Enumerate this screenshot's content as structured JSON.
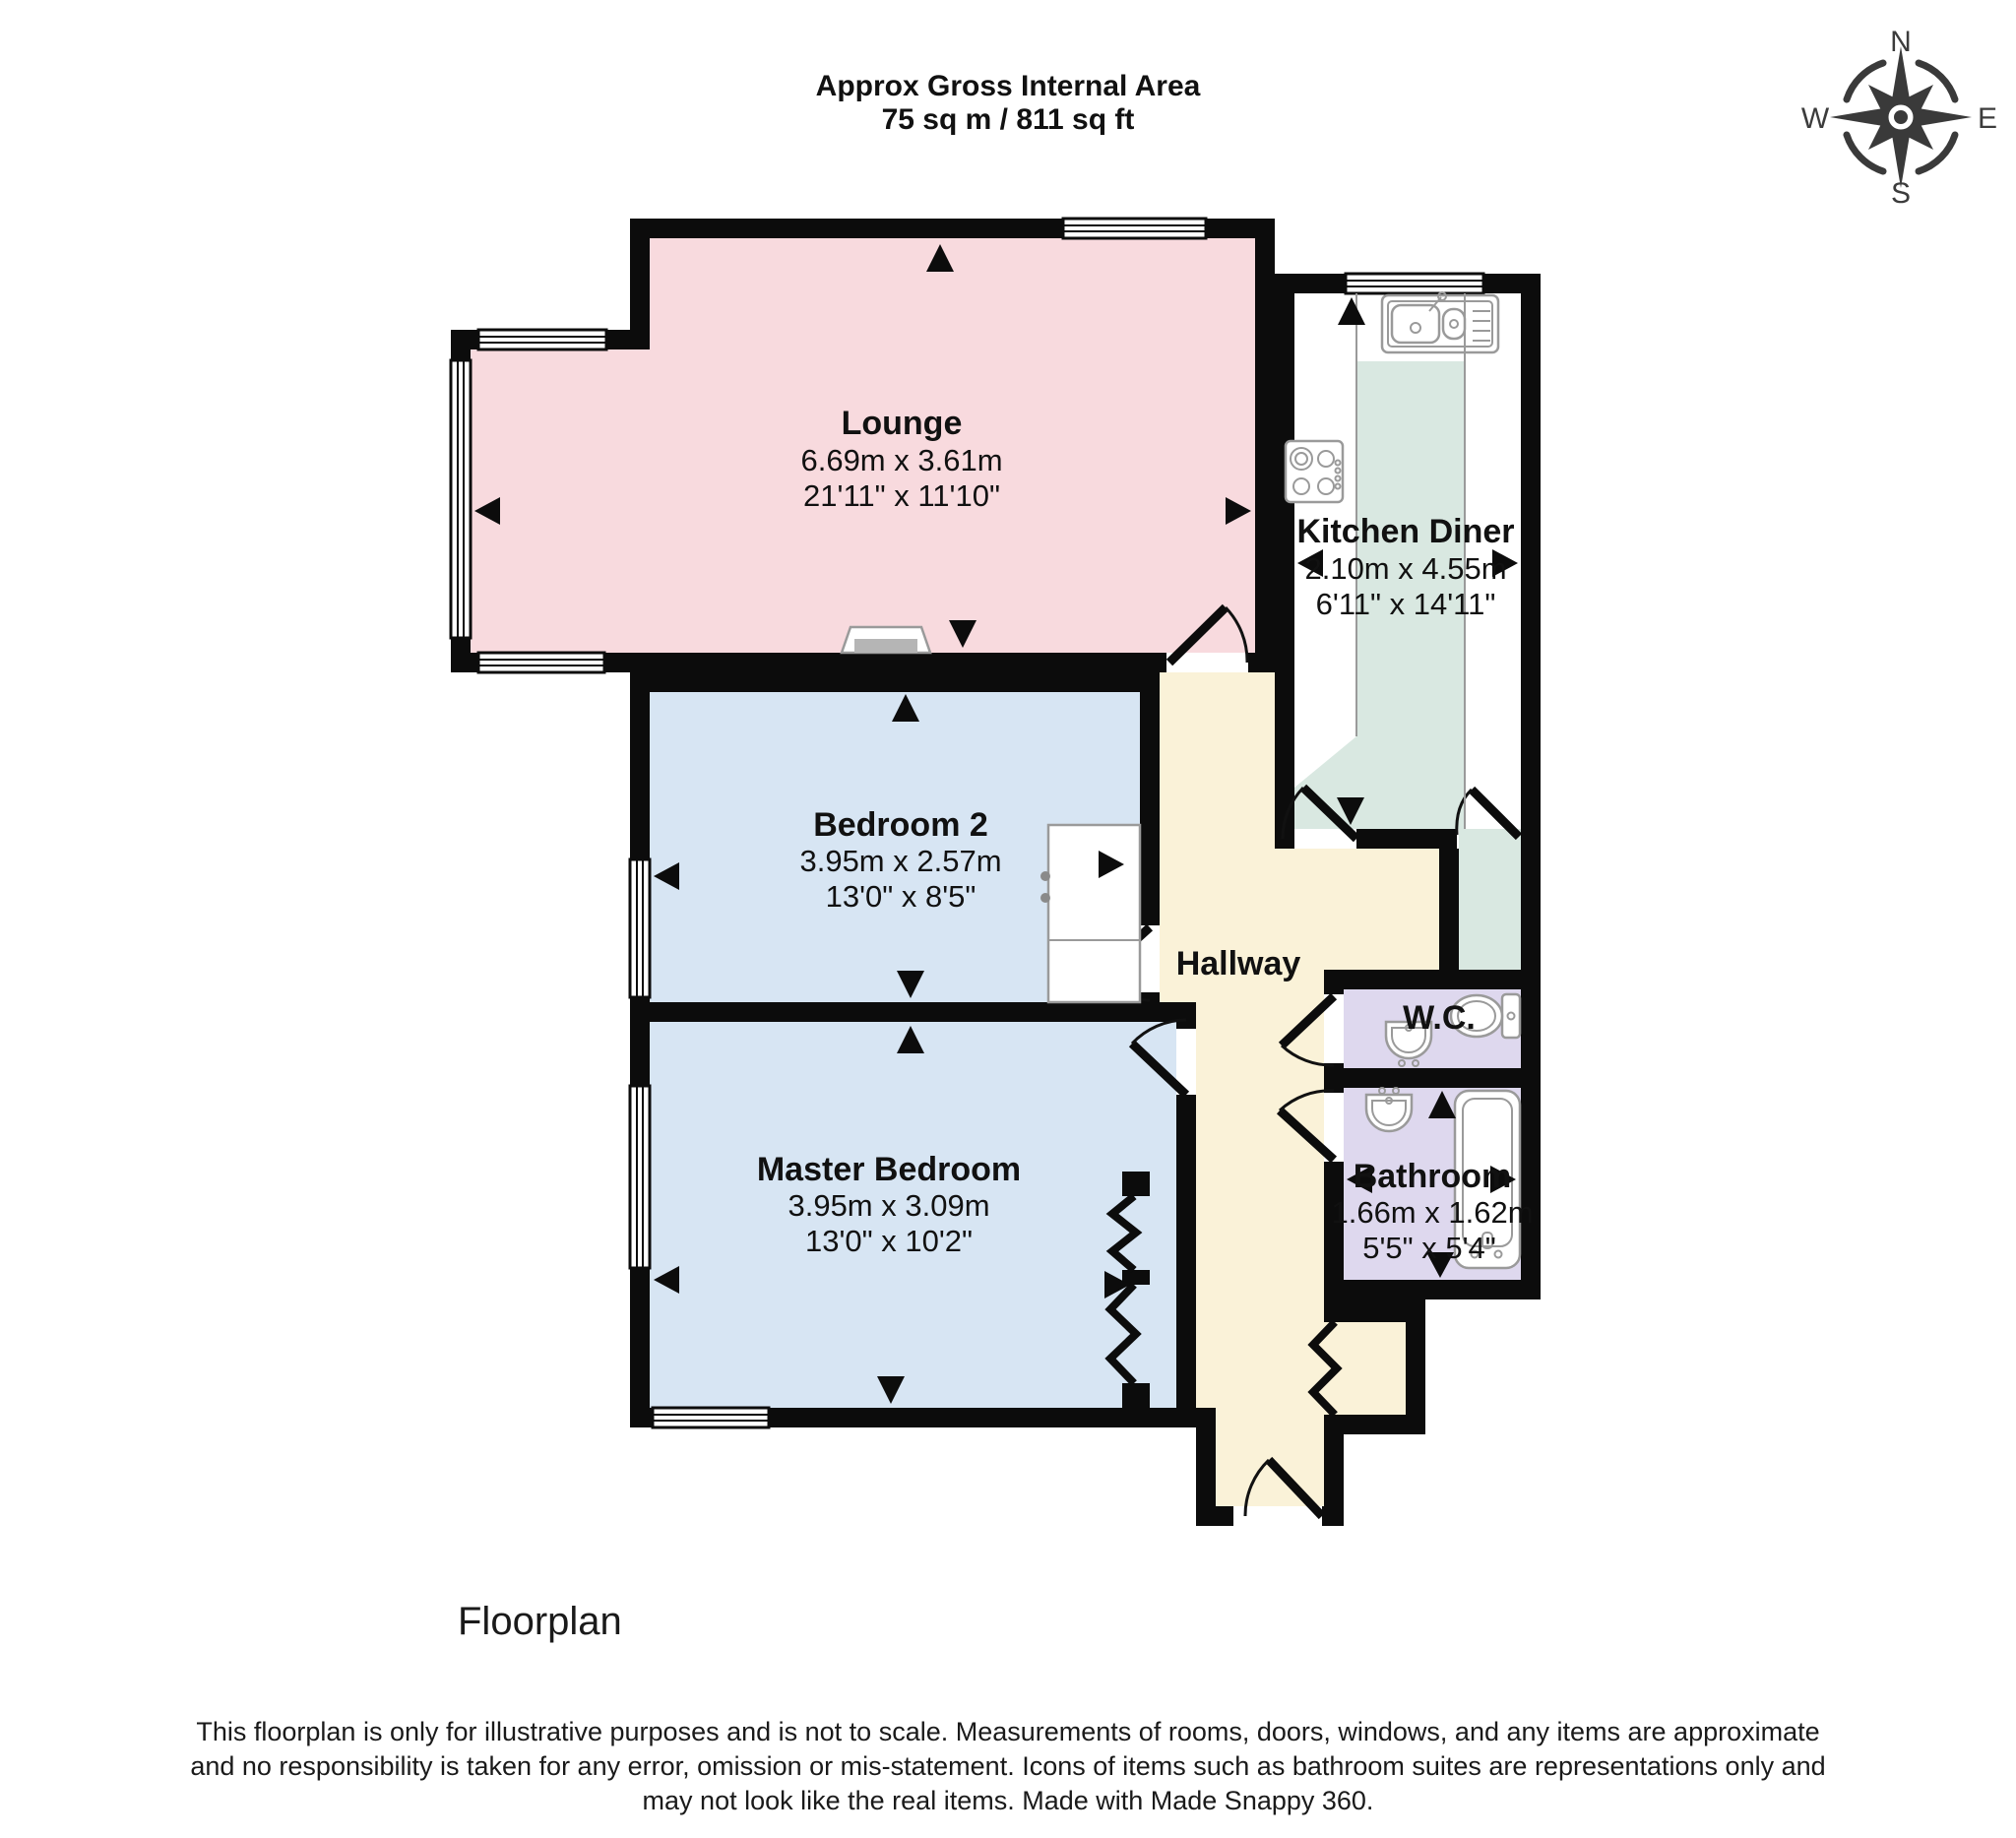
{
  "header": {
    "title_line1": "Approx Gross Internal Area",
    "title_line2": "75 sq m / 811 sq ft"
  },
  "compass": {
    "n": "N",
    "e": "E",
    "s": "S",
    "w": "W"
  },
  "rooms": [
    {
      "id": "lounge",
      "name": "Lounge",
      "metric": "6.69m x 3.61m",
      "imperial": "21'11\" x 11'10\""
    },
    {
      "id": "kitchen-diner",
      "name": "Kitchen Diner",
      "metric": "2.10m x 4.55m",
      "imperial": "6'11\" x 14'11\""
    },
    {
      "id": "bedroom-2",
      "name": "Bedroom 2",
      "metric": "3.95m x 2.57m",
      "imperial": "13'0\" x 8'5\""
    },
    {
      "id": "master-bedroom",
      "name": "Master Bedroom",
      "metric": "3.95m x 3.09m",
      "imperial": "13'0\" x 10'2\""
    },
    {
      "id": "hallway",
      "name": "Hallway"
    },
    {
      "id": "wc",
      "name": "W.C."
    },
    {
      "id": "bathroom",
      "name": "Bathroom",
      "metric": "1.66m x 1.62m",
      "imperial": "5'5\" x 5'4\""
    }
  ],
  "footer": {
    "caption": "Floorplan",
    "disclaimer_line1": "This floorplan is only for illustrative purposes and is not to scale. Measurements of rooms, doors, windows, and any items are approximate",
    "disclaimer_line2": "and no responsibility is taken for any error, omission or mis-statement. Icons of items such as bathroom suites are representations only and",
    "disclaimer_line3": "may not look like the real items. Made with Made Snappy 360."
  },
  "colors": {
    "wall": "#0c0c0c",
    "lounge": "#f8dade",
    "bedroom": "#d7e5f3",
    "kitchen_floor": "#d9e8e1",
    "hallway": "#faf2d8",
    "bathroom": "#ded8ee",
    "fixture_stroke": "#9a9a9a"
  }
}
